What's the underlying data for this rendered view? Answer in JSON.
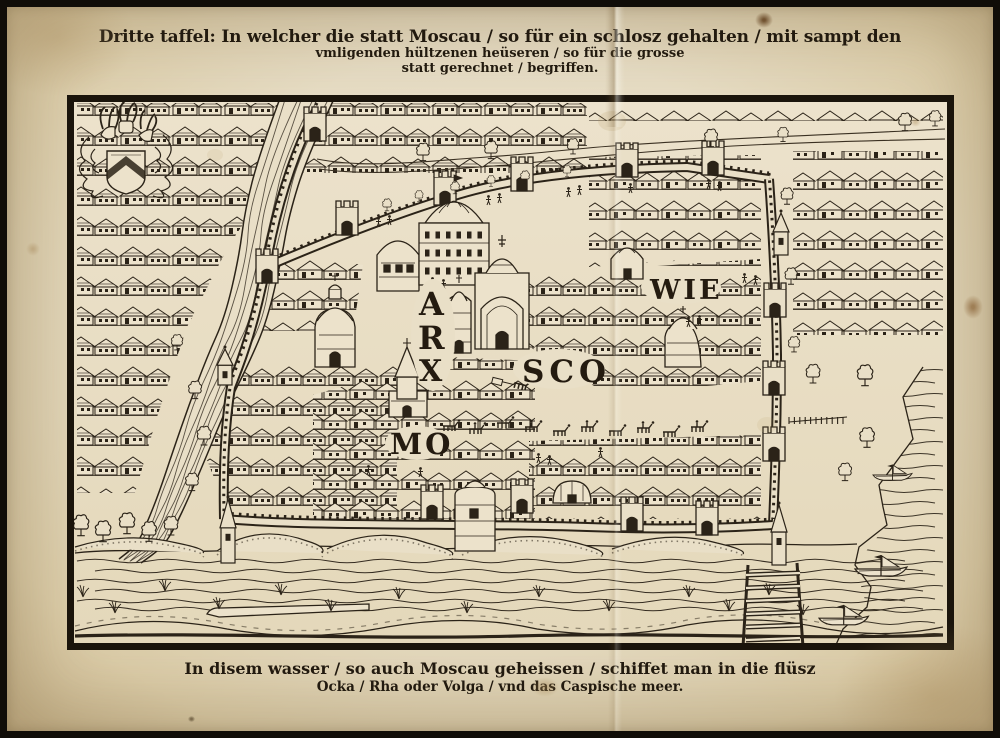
{
  "page": {
    "paper_color": "#e7dcc4",
    "ink_color": "#2b2318",
    "frame_color": "#15100a"
  },
  "title": {
    "line1": "Dritte taffel: In welcher die statt Moscau / so für ein schlosz gehalten / mit sampt den",
    "line2": "vmligenden hültzenen heüseren / so für die grosse",
    "line3": "statt gerechnet / begriffen."
  },
  "map": {
    "labels": {
      "arx": [
        "A",
        "R",
        "X"
      ],
      "sco": "SCO",
      "wie": "WIE",
      "mo": "MO"
    }
  },
  "caption": {
    "line1": "In disem wasser / so auch Moscau geheissen / schiffet man in die flüsz",
    "line2": "Ocka / Rha oder Volga / vnd das Caspische meer."
  }
}
